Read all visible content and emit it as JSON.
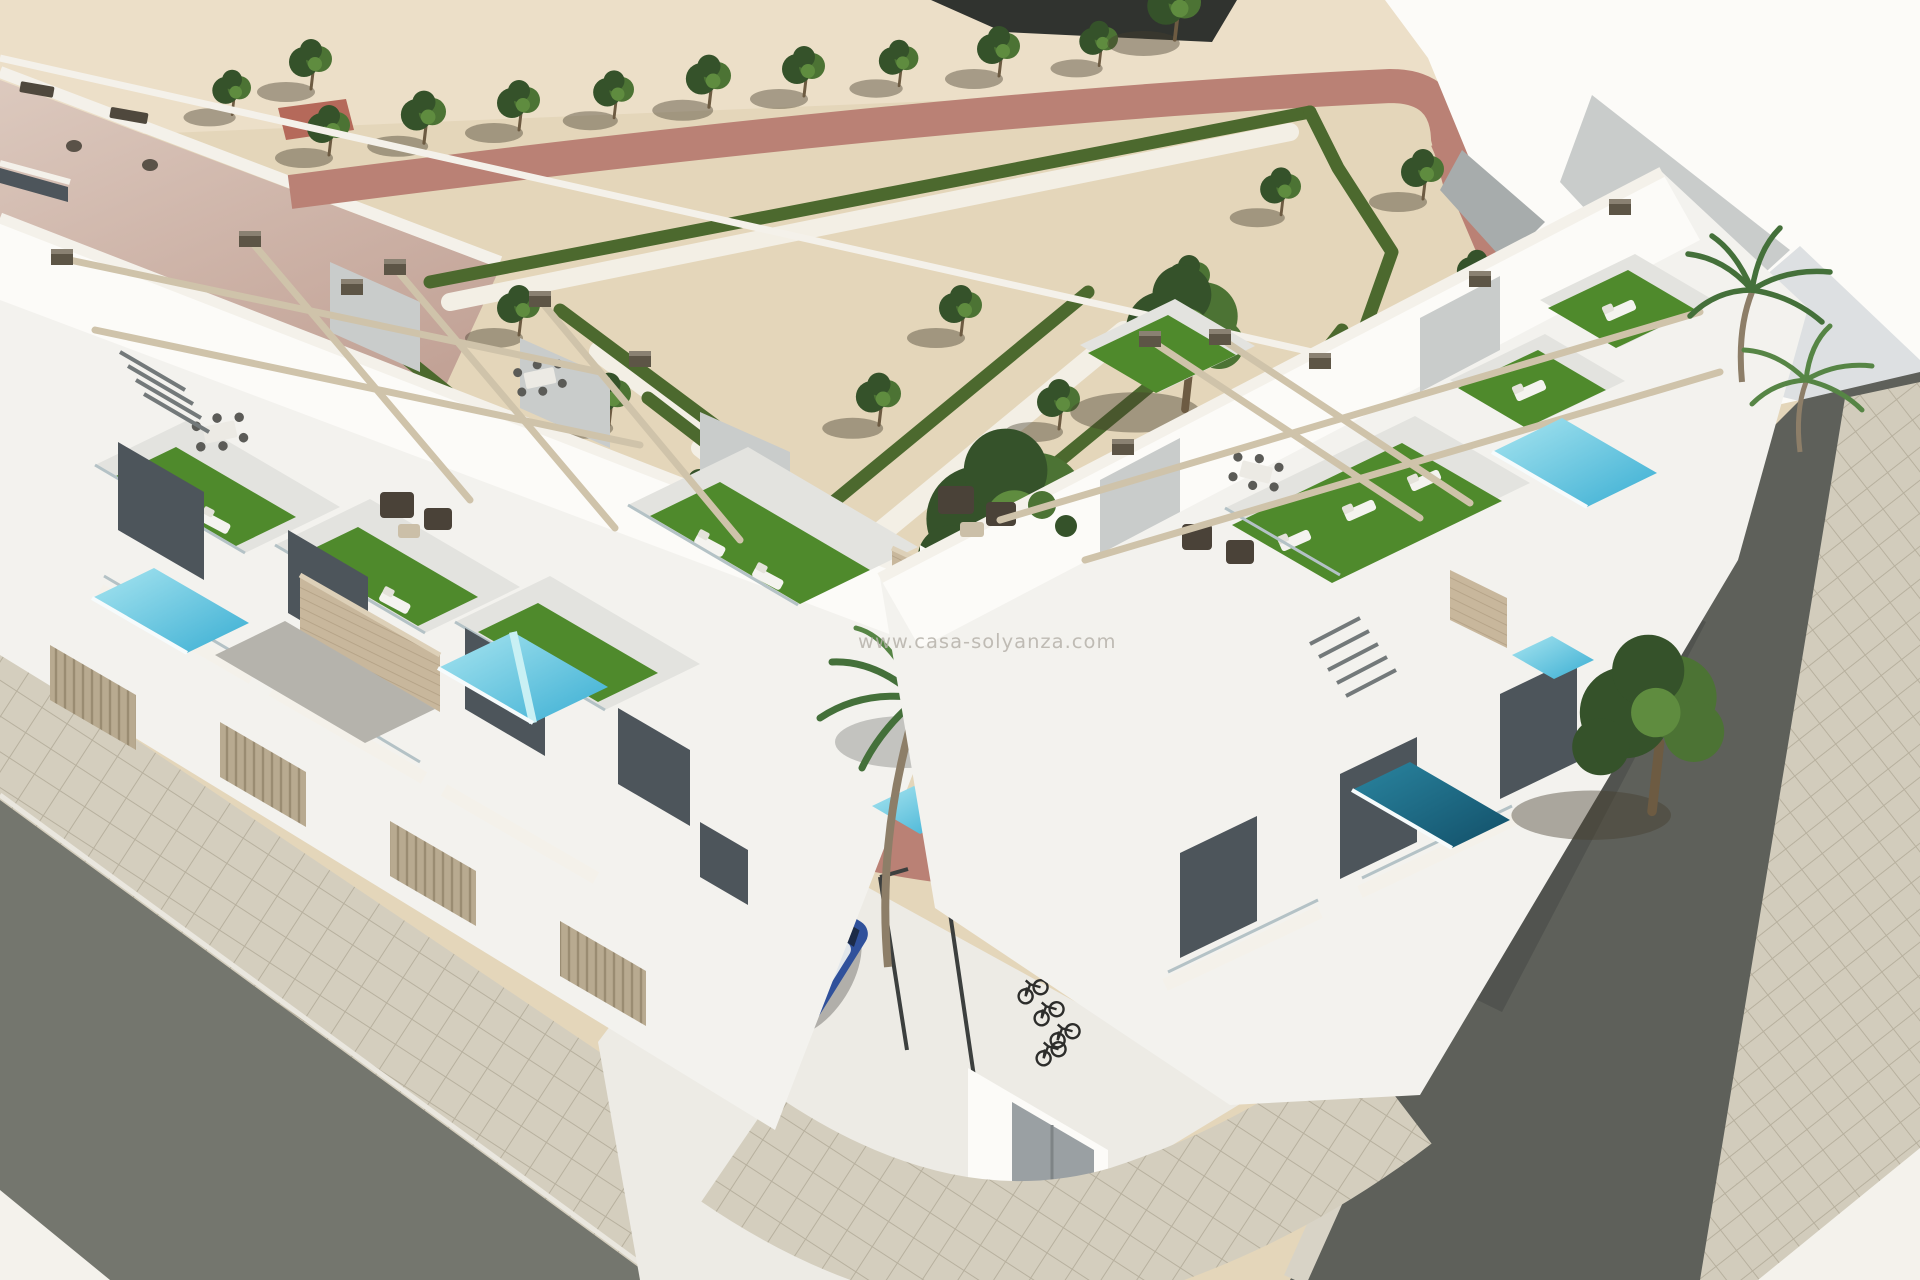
{
  "meta": {
    "type": "architectural-3d-render",
    "description": "Aerial 3D visualization of a modern white townhouse development on a street corner: rooftop terraces with artificial turf and pergolas, private plunge pools, a formal hedge-parterre park with young trees, terracotta walkways, asphalt streets with paved sidewalks, parked cars and bicycles."
  },
  "watermark": {
    "text": "www.casa-solyanza.com"
  },
  "palette": {
    "sand": "#e4d6ba",
    "sandLight": "#ecdfc8",
    "darkBand": "#30332f",
    "roofPink": "#d6bfb4",
    "roofPinkDeep": "#c2a296",
    "parapet": "#f4f1ea",
    "parkPath": "#ba8175",
    "hedge": "#4c692e",
    "whitePath": "#f3efe5",
    "treeDark": "#35522a",
    "treeMid": "#4c7334",
    "treeLight": "#5f8c3f",
    "trunk": "#6d5b42",
    "castShadow": "rgba(70,62,46,0.42)",
    "turf": "#4f8a2c",
    "turfDark": "#407423",
    "wallWhite": "#f3f2ee",
    "wallBright": "#fcfbf8",
    "wallShadow": "#c9cccb",
    "wallDark": "#a7acac",
    "wallDeep": "#8d9294",
    "glass": "#4d555b",
    "glassLight": "#6c747a",
    "beam": "#cfc3aa",
    "beamCap": "#5d5546",
    "beamCapTop": "#8a8172",
    "fence": "#b8aa90",
    "fenceLine": "#9a8c72",
    "stone": "#c8b79c",
    "stoneLine": "#b2a084",
    "poolAquaLight": "#a8e5f0",
    "poolAqua": "#45b5d8",
    "poolDeep": "#1e7390",
    "poolDeepDark": "#124f68",
    "asphaltL": "#74766e",
    "asphaltR": "#5e605a",
    "sidewalk": "#d4cebe",
    "sidewalkLine": "#b7b09e",
    "curb": "#eae7df",
    "cornerWhite": "#f4f2ec",
    "forecourt": "#edebe5",
    "carBrownBody": "#7b7263",
    "carBrownRoof": "#958c7c",
    "carBlueBody": "#30519b",
    "carBlueRoof": "#e2e7eb",
    "carGlass": "#27434e",
    "bikeColor": "#2d2d2b",
    "utilDoor": "#9aa0a3",
    "watermark": "#b6b2aa"
  },
  "objects": [
    "left townhouse row with rooftop terraces",
    "right townhouse row with rooftop terraces",
    "artificial turf roof gardens",
    "sun loungers",
    "wicker lounge furniture",
    "rooftop dining sets",
    "timber pergola beams",
    "private plunge pools",
    "stone-clad stair walls",
    "central palm tree",
    "side palm trees",
    "formal garden parterre with clipped hedges",
    "rows of young trees",
    "terracotta garden walkways",
    "sandy plaza ground",
    "neighboring building with pink flat roof",
    "asphalt corner streets",
    "paved sidewalks",
    "parked brown car",
    "parked blue car",
    "bicycles at rack",
    "white utility structure with gray doors",
    "watermark"
  ]
}
